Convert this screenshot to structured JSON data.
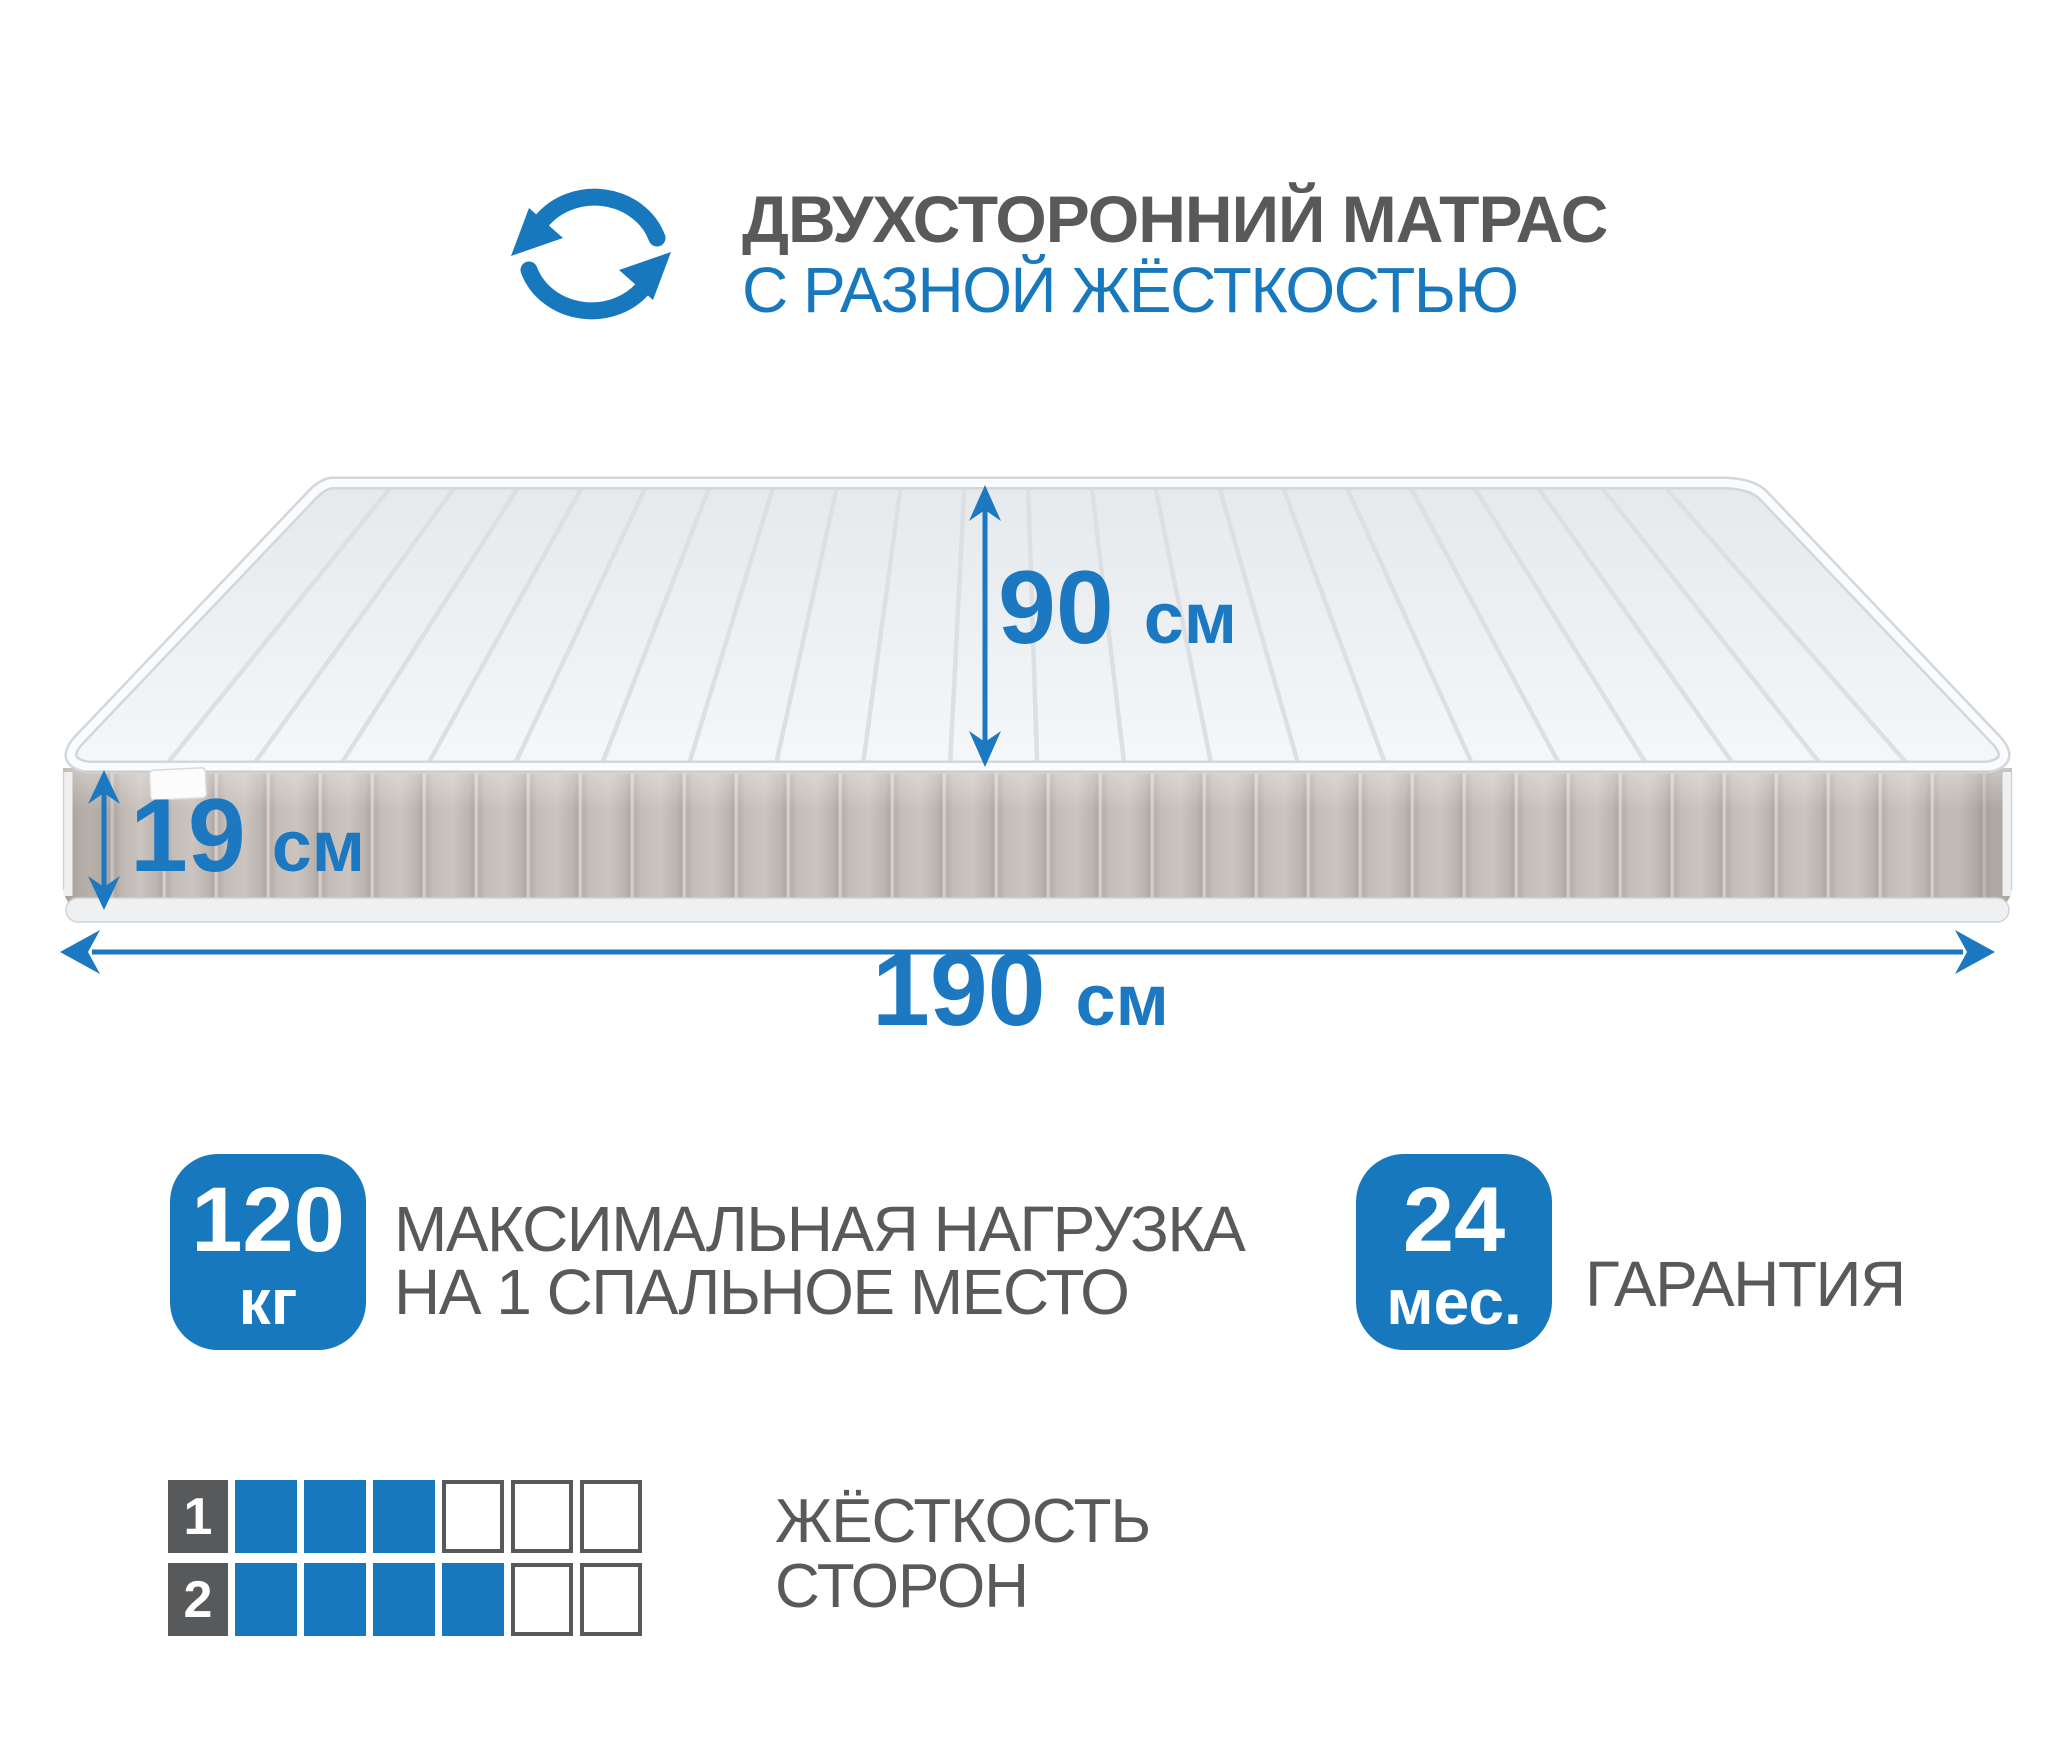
{
  "colors": {
    "accent_blue": "#1878be",
    "dimension_blue": "#1b78c1",
    "text_gray": "#58595b",
    "mattress_side_beige": "#c8c0bb",
    "mattress_top_gray": "#eef0f2"
  },
  "header": {
    "icon": "rotate-arrows-icon",
    "title": "ДВУХСТОРОННИЙ МАТРАС",
    "subtitle": "С РАЗНОЙ ЖЁСТКОСТЬЮ"
  },
  "dimensions": {
    "width": {
      "value": "90",
      "unit": "см"
    },
    "height": {
      "value": "19",
      "unit": "см"
    },
    "length": {
      "value": "190",
      "unit": "см"
    }
  },
  "max_load": {
    "value": "120",
    "unit": "кг",
    "caption_line1": "МАКСИМАЛЬНАЯ НАГРУЗКА",
    "caption_line2": "НА 1 СПАЛЬНОЕ МЕСТО"
  },
  "warranty": {
    "value": "24",
    "unit": "мес.",
    "label": "ГАРАНТИЯ"
  },
  "firmness": {
    "label_line1": "ЖЁСТКОСТЬ",
    "label_line2": "СТОРОН",
    "rows": [
      {
        "side": "1",
        "filled": 3,
        "total": 6
      },
      {
        "side": "2",
        "filled": 4,
        "total": 6
      }
    ]
  }
}
